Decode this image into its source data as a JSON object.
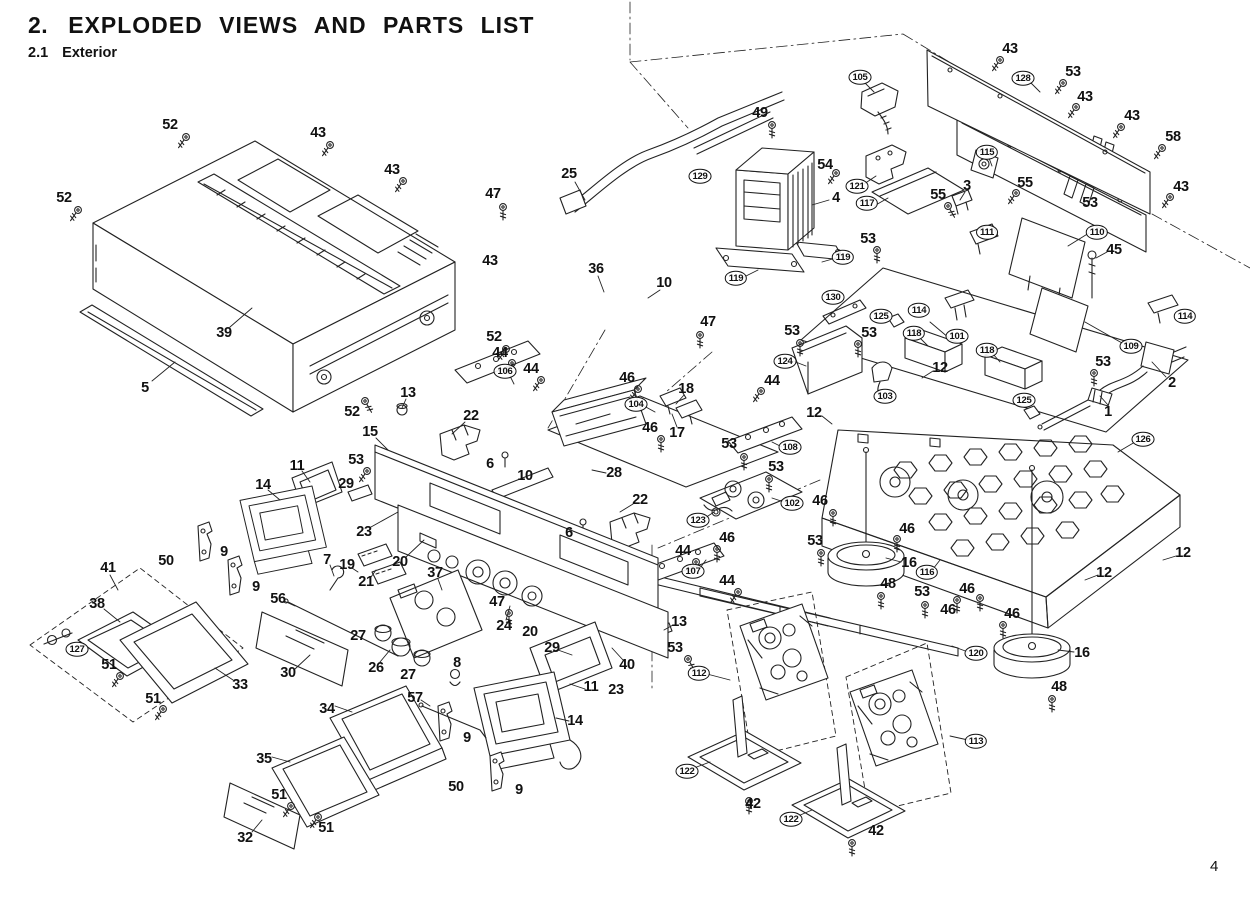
{
  "header": {
    "section_no": "2.",
    "title": "EXPLODED VIEWS AND PARTS LIST",
    "sub_no": "2.1",
    "sub_title": "Exterior"
  },
  "page_number": "4",
  "diagram": {
    "labels": [
      {
        "t": "52",
        "x": 170,
        "y": 125
      },
      {
        "t": "43",
        "x": 318,
        "y": 133
      },
      {
        "t": "43",
        "x": 392,
        "y": 170
      },
      {
        "t": "52",
        "x": 64,
        "y": 198
      },
      {
        "t": "39",
        "x": 224,
        "y": 333
      },
      {
        "t": "5",
        "x": 145,
        "y": 388
      },
      {
        "t": "52",
        "x": 352,
        "y": 412
      },
      {
        "t": "13",
        "x": 408,
        "y": 393
      },
      {
        "t": "25",
        "x": 569,
        "y": 174
      },
      {
        "t": "47",
        "x": 493,
        "y": 194
      },
      {
        "t": "49",
        "x": 760,
        "y": 113
      },
      {
        "t": "54",
        "x": 825,
        "y": 165
      },
      {
        "t": "4",
        "x": 836,
        "y": 198
      },
      {
        "t": "129",
        "x": 700,
        "y": 176,
        "c": 1
      },
      {
        "t": "105",
        "x": 860,
        "y": 77,
        "c": 1
      },
      {
        "t": "121",
        "x": 857,
        "y": 186,
        "c": 1
      },
      {
        "t": "117",
        "x": 867,
        "y": 203,
        "c": 1
      },
      {
        "t": "119",
        "x": 736,
        "y": 278,
        "c": 1
      },
      {
        "t": "119",
        "x": 843,
        "y": 257,
        "c": 1
      },
      {
        "t": "43",
        "x": 490,
        "y": 261
      },
      {
        "t": "36",
        "x": 596,
        "y": 269
      },
      {
        "t": "10",
        "x": 664,
        "y": 283
      },
      {
        "t": "47",
        "x": 708,
        "y": 322
      },
      {
        "t": "130",
        "x": 833,
        "y": 297,
        "c": 1
      },
      {
        "t": "53",
        "x": 792,
        "y": 331
      },
      {
        "t": "124",
        "x": 785,
        "y": 361,
        "c": 1
      },
      {
        "t": "43",
        "x": 1010,
        "y": 49
      },
      {
        "t": "128",
        "x": 1023,
        "y": 78,
        "c": 1
      },
      {
        "t": "53",
        "x": 1073,
        "y": 72
      },
      {
        "t": "43",
        "x": 1085,
        "y": 97
      },
      {
        "t": "43",
        "x": 1132,
        "y": 116
      },
      {
        "t": "58",
        "x": 1173,
        "y": 137
      },
      {
        "t": "43",
        "x": 1181,
        "y": 187
      },
      {
        "t": "115",
        "x": 987,
        "y": 152,
        "c": 1
      },
      {
        "t": "55",
        "x": 938,
        "y": 195
      },
      {
        "t": "3",
        "x": 967,
        "y": 186
      },
      {
        "t": "55",
        "x": 1025,
        "y": 183
      },
      {
        "t": "53",
        "x": 1090,
        "y": 203
      },
      {
        "t": "111",
        "x": 987,
        "y": 232,
        "c": 1
      },
      {
        "t": "110",
        "x": 1097,
        "y": 232,
        "c": 1
      },
      {
        "t": "45",
        "x": 1114,
        "y": 250
      },
      {
        "t": "53",
        "x": 868,
        "y": 239
      },
      {
        "t": "114",
        "x": 919,
        "y": 310,
        "c": 1
      },
      {
        "t": "101",
        "x": 957,
        "y": 336,
        "c": 1
      },
      {
        "t": "114",
        "x": 1185,
        "y": 316,
        "c": 1
      },
      {
        "t": "109",
        "x": 1131,
        "y": 346,
        "c": 1
      },
      {
        "t": "53",
        "x": 1103,
        "y": 362
      },
      {
        "t": "2",
        "x": 1172,
        "y": 383
      },
      {
        "t": "1",
        "x": 1108,
        "y": 412
      },
      {
        "t": "126",
        "x": 1143,
        "y": 439,
        "c": 1
      },
      {
        "t": "125",
        "x": 881,
        "y": 316,
        "c": 1
      },
      {
        "t": "53",
        "x": 869,
        "y": 333
      },
      {
        "t": "118",
        "x": 914,
        "y": 333,
        "c": 1
      },
      {
        "t": "12",
        "x": 940,
        "y": 368
      },
      {
        "t": "103",
        "x": 885,
        "y": 396,
        "c": 1
      },
      {
        "t": "118",
        "x": 987,
        "y": 350,
        "c": 1
      },
      {
        "t": "125",
        "x": 1024,
        "y": 400,
        "c": 1
      },
      {
        "t": "12",
        "x": 814,
        "y": 413
      },
      {
        "t": "44",
        "x": 772,
        "y": 381
      },
      {
        "t": "52",
        "x": 494,
        "y": 337
      },
      {
        "t": "44",
        "x": 500,
        "y": 353
      },
      {
        "t": "106",
        "x": 505,
        "y": 371,
        "c": 1
      },
      {
        "t": "44",
        "x": 531,
        "y": 369
      },
      {
        "t": "46",
        "x": 627,
        "y": 378
      },
      {
        "t": "104",
        "x": 636,
        "y": 404,
        "c": 1
      },
      {
        "t": "18",
        "x": 686,
        "y": 389
      },
      {
        "t": "17",
        "x": 677,
        "y": 433
      },
      {
        "t": "46",
        "x": 650,
        "y": 428
      },
      {
        "t": "22",
        "x": 471,
        "y": 416
      },
      {
        "t": "15",
        "x": 370,
        "y": 432
      },
      {
        "t": "53",
        "x": 356,
        "y": 460
      },
      {
        "t": "29",
        "x": 346,
        "y": 484
      },
      {
        "t": "6",
        "x": 490,
        "y": 464
      },
      {
        "t": "10",
        "x": 525,
        "y": 476
      },
      {
        "t": "28",
        "x": 614,
        "y": 473
      },
      {
        "t": "22",
        "x": 640,
        "y": 500
      },
      {
        "t": "6",
        "x": 569,
        "y": 533
      },
      {
        "t": "11",
        "x": 297,
        "y": 466
      },
      {
        "t": "14",
        "x": 263,
        "y": 485
      },
      {
        "t": "23",
        "x": 364,
        "y": 532
      },
      {
        "t": "20",
        "x": 400,
        "y": 562
      },
      {
        "t": "19",
        "x": 347,
        "y": 565
      },
      {
        "t": "21",
        "x": 366,
        "y": 582
      },
      {
        "t": "7",
        "x": 327,
        "y": 560
      },
      {
        "t": "56",
        "x": 278,
        "y": 599
      },
      {
        "t": "37",
        "x": 435,
        "y": 573
      },
      {
        "t": "47",
        "x": 497,
        "y": 602
      },
      {
        "t": "24",
        "x": 504,
        "y": 626
      },
      {
        "t": "20",
        "x": 530,
        "y": 632
      },
      {
        "t": "27",
        "x": 358,
        "y": 636
      },
      {
        "t": "26",
        "x": 376,
        "y": 668
      },
      {
        "t": "27",
        "x": 408,
        "y": 675
      },
      {
        "t": "8",
        "x": 457,
        "y": 663
      },
      {
        "t": "57",
        "x": 415,
        "y": 698
      },
      {
        "t": "29",
        "x": 552,
        "y": 648
      },
      {
        "t": "11",
        "x": 591,
        "y": 687
      },
      {
        "t": "40",
        "x": 627,
        "y": 665
      },
      {
        "t": "23",
        "x": 616,
        "y": 690
      },
      {
        "t": "13",
        "x": 679,
        "y": 622
      },
      {
        "t": "53",
        "x": 675,
        "y": 648
      },
      {
        "t": "14",
        "x": 575,
        "y": 721
      },
      {
        "t": "9",
        "x": 467,
        "y": 738
      },
      {
        "t": "50",
        "x": 456,
        "y": 787
      },
      {
        "t": "9",
        "x": 519,
        "y": 790
      },
      {
        "t": "9",
        "x": 224,
        "y": 552
      },
      {
        "t": "9",
        "x": 256,
        "y": 587
      },
      {
        "t": "50",
        "x": 166,
        "y": 561
      },
      {
        "t": "53",
        "x": 729,
        "y": 444
      },
      {
        "t": "53",
        "x": 776,
        "y": 467
      },
      {
        "t": "108",
        "x": 790,
        "y": 447,
        "c": 1
      },
      {
        "t": "102",
        "x": 792,
        "y": 503,
        "c": 1
      },
      {
        "t": "123",
        "x": 698,
        "y": 520,
        "c": 1
      },
      {
        "t": "44",
        "x": 683,
        "y": 551
      },
      {
        "t": "107",
        "x": 693,
        "y": 571,
        "c": 1
      },
      {
        "t": "44",
        "x": 727,
        "y": 581
      },
      {
        "t": "46",
        "x": 727,
        "y": 538
      },
      {
        "t": "53",
        "x": 815,
        "y": 541
      },
      {
        "t": "46",
        "x": 820,
        "y": 501
      },
      {
        "t": "46",
        "x": 907,
        "y": 529
      },
      {
        "t": "16",
        "x": 909,
        "y": 563
      },
      {
        "t": "48",
        "x": 888,
        "y": 584
      },
      {
        "t": "116",
        "x": 927,
        "y": 572,
        "c": 1
      },
      {
        "t": "46",
        "x": 967,
        "y": 589
      },
      {
        "t": "53",
        "x": 922,
        "y": 592
      },
      {
        "t": "46",
        "x": 948,
        "y": 610
      },
      {
        "t": "46",
        "x": 1012,
        "y": 614
      },
      {
        "t": "12",
        "x": 1104,
        "y": 573
      },
      {
        "t": "12",
        "x": 1183,
        "y": 553
      },
      {
        "t": "120",
        "x": 976,
        "y": 653,
        "c": 1
      },
      {
        "t": "16",
        "x": 1082,
        "y": 653
      },
      {
        "t": "48",
        "x": 1059,
        "y": 687
      },
      {
        "t": "112",
        "x": 699,
        "y": 673,
        "c": 1
      },
      {
        "t": "113",
        "x": 976,
        "y": 741,
        "c": 1
      },
      {
        "t": "122",
        "x": 687,
        "y": 771,
        "c": 1
      },
      {
        "t": "42",
        "x": 753,
        "y": 804
      },
      {
        "t": "122",
        "x": 791,
        "y": 819,
        "c": 1
      },
      {
        "t": "42",
        "x": 876,
        "y": 831
      },
      {
        "t": "41",
        "x": 108,
        "y": 568
      },
      {
        "t": "38",
        "x": 97,
        "y": 604
      },
      {
        "t": "127",
        "x": 77,
        "y": 649,
        "c": 1
      },
      {
        "t": "51",
        "x": 109,
        "y": 665
      },
      {
        "t": "51",
        "x": 153,
        "y": 699
      },
      {
        "t": "33",
        "x": 240,
        "y": 685
      },
      {
        "t": "30",
        "x": 288,
        "y": 673
      },
      {
        "t": "34",
        "x": 327,
        "y": 709
      },
      {
        "t": "35",
        "x": 264,
        "y": 759
      },
      {
        "t": "51",
        "x": 279,
        "y": 795
      },
      {
        "t": "51",
        "x": 326,
        "y": 828
      },
      {
        "t": "32",
        "x": 245,
        "y": 838
      }
    ]
  }
}
